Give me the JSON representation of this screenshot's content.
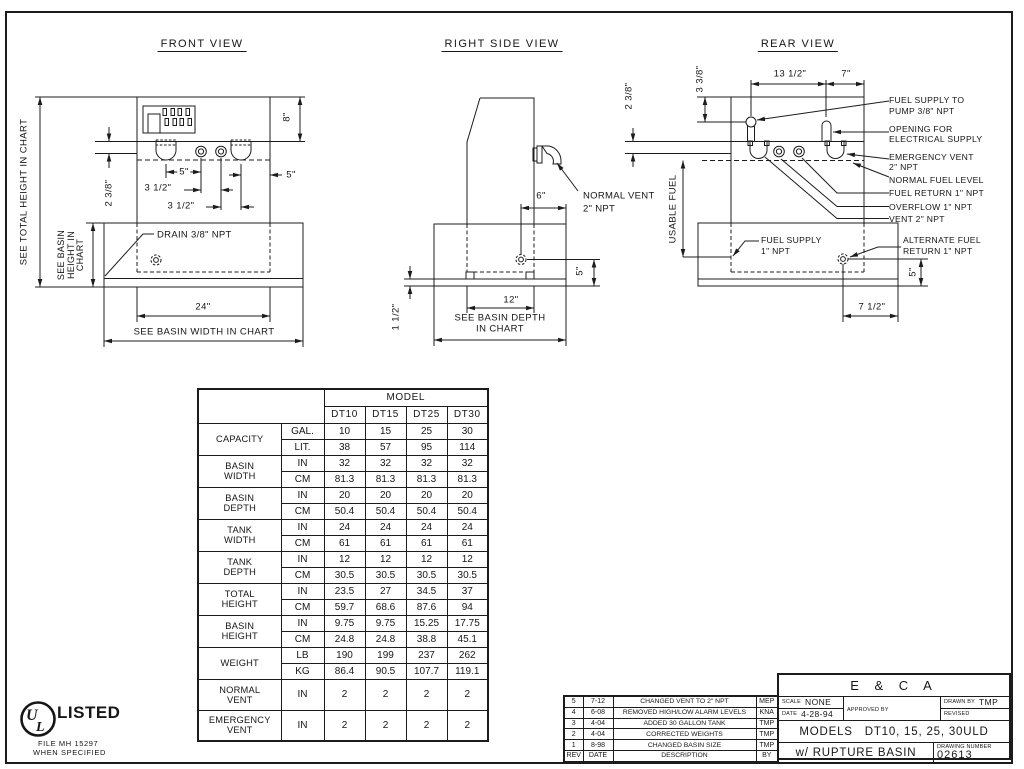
{
  "page": {
    "background": "#ffffff",
    "ink": "#1c1c1c"
  },
  "front": {
    "title": "FRONT VIEW",
    "see_total_height": "SEE TOTAL HEIGHT IN CHART",
    "see_basin_height": [
      "SEE BASIN",
      "HEIGHT IN",
      "CHART"
    ],
    "dim_2_3_8": "2 3/8\"",
    "dim_5_a": "5\"",
    "dim_3_1_2_a": "3 1/2\"",
    "dim_3_1_2_b": "3 1/2\"",
    "dim_5_b": "5\"",
    "dim_8": "8\"",
    "drain": "DRAIN 3/8\" NPT",
    "dim_24": "24\"",
    "see_basin_width": "SEE BASIN WIDTH IN CHART"
  },
  "side": {
    "title": "RIGHT SIDE VIEW",
    "normal_vent": [
      "NORMAL VENT",
      "2\" NPT"
    ],
    "dim_6": "6\"",
    "dim_12": "12\"",
    "see_basin_depth": [
      "SEE BASIN DEPTH",
      "IN CHART"
    ],
    "dim_1_1_2": "1 1/2\"",
    "dim_5": "5\""
  },
  "rear": {
    "title": "REAR VIEW",
    "dim_13_1_2": "13 1/2\"",
    "dim_7": "7\"",
    "dim_3_3_8": "3 3/8\"",
    "dim_2_3_8": "2 3/8\"",
    "usable_fuel": "USABLE FUEL",
    "callouts": {
      "pump": [
        "FUEL SUPPLY TO",
        "PUMP 3/8\" NPT"
      ],
      "electrical": [
        "OPENING FOR",
        "ELECTRICAL SUPPLY"
      ],
      "emergency": [
        "EMERGENCY VENT",
        "2\" NPT"
      ],
      "level": [
        "NORMAL FUEL LEVEL"
      ],
      "fuel_return": [
        "FUEL RETURN 1\" NPT"
      ],
      "overflow": [
        "OVERFLOW 1\" NPT"
      ],
      "vent": [
        "VENT 2\" NPT"
      ],
      "alt_return": [
        "ALTERNATE FUEL",
        "RETURN 1\" NPT"
      ],
      "fuel_supply": [
        "FUEL SUPPLY",
        "1\" NPT"
      ]
    },
    "dim_7_1_2": "7 1/2\"",
    "dim_5": "5\""
  },
  "chart_data": {
    "type": "table",
    "title": "MODEL",
    "columns": [
      "DT10",
      "DT15",
      "DT25",
      "DT30"
    ],
    "groups": [
      {
        "label_lines": [
          "CAPACITY"
        ],
        "rows": [
          {
            "unit": "GAL.",
            "values": [
              "10",
              "15",
              "25",
              "30"
            ]
          },
          {
            "unit": "LIT.",
            "values": [
              "38",
              "57",
              "95",
              "114"
            ]
          }
        ]
      },
      {
        "label_lines": [
          "BASIN",
          "WIDTH"
        ],
        "rows": [
          {
            "unit": "IN",
            "values": [
              "32",
              "32",
              "32",
              "32"
            ]
          },
          {
            "unit": "CM",
            "values": [
              "81.3",
              "81.3",
              "81.3",
              "81.3"
            ]
          }
        ]
      },
      {
        "label_lines": [
          "BASIN",
          "DEPTH"
        ],
        "rows": [
          {
            "unit": "IN",
            "values": [
              "20",
              "20",
              "20",
              "20"
            ]
          },
          {
            "unit": "CM",
            "values": [
              "50.4",
              "50.4",
              "50.4",
              "50.4"
            ]
          }
        ]
      },
      {
        "label_lines": [
          "TANK",
          "WIDTH"
        ],
        "rows": [
          {
            "unit": "IN",
            "values": [
              "24",
              "24",
              "24",
              "24"
            ]
          },
          {
            "unit": "CM",
            "values": [
              "61",
              "61",
              "61",
              "61"
            ]
          }
        ]
      },
      {
        "label_lines": [
          "TANK",
          "DEPTH"
        ],
        "rows": [
          {
            "unit": "IN",
            "values": [
              "12",
              "12",
              "12",
              "12"
            ]
          },
          {
            "unit": "CM",
            "values": [
              "30.5",
              "30.5",
              "30.5",
              "30.5"
            ]
          }
        ]
      },
      {
        "label_lines": [
          "TOTAL",
          "HEIGHT"
        ],
        "rows": [
          {
            "unit": "IN",
            "values": [
              "23.5",
              "27",
              "34.5",
              "37"
            ]
          },
          {
            "unit": "CM",
            "values": [
              "59.7",
              "68.6",
              "87.6",
              "94"
            ]
          }
        ]
      },
      {
        "label_lines": [
          "BASIN",
          "HEIGHT"
        ],
        "rows": [
          {
            "unit": "IN",
            "values": [
              "9.75",
              "9.75",
              "15.25",
              "17.75"
            ]
          },
          {
            "unit": "CM",
            "values": [
              "24.8",
              "24.8",
              "38.8",
              "45.1"
            ]
          }
        ]
      },
      {
        "label_lines": [
          "WEIGHT"
        ],
        "rows": [
          {
            "unit": "LB",
            "values": [
              "190",
              "199",
              "237",
              "262"
            ]
          },
          {
            "unit": "KG",
            "values": [
              "86.4",
              "90.5",
              "107.7",
              "119.1"
            ]
          }
        ]
      },
      {
        "label_lines": [
          "NORMAL",
          "VENT"
        ],
        "tall": true,
        "rows": [
          {
            "unit": "IN",
            "values": [
              "2",
              "2",
              "2",
              "2"
            ]
          }
        ]
      },
      {
        "label_lines": [
          "EMERGENCY",
          "VENT"
        ],
        "tall": true,
        "rows": [
          {
            "unit": "IN",
            "values": [
              "2",
              "2",
              "2",
              "2"
            ]
          }
        ]
      }
    ]
  },
  "revisions": {
    "header": {
      "rev": "REV",
      "date": "DATE",
      "description": "DESCRIPTION",
      "by": "BY"
    },
    "rows": [
      {
        "rev": "5",
        "date": "7-12",
        "description": "CHANGED VENT TO 2\" NPT",
        "by": "MEP"
      },
      {
        "rev": "4",
        "date": "6-08",
        "description": "REMOVED HIGH/LOW ALARM LEVELS",
        "by": "KNA"
      },
      {
        "rev": "3",
        "date": "4-04",
        "description": "ADDED 30 GALLON TANK",
        "by": "TMP"
      },
      {
        "rev": "2",
        "date": "4-04",
        "description": "CORRECTED WEIGHTS",
        "by": "TMP"
      },
      {
        "rev": "1",
        "date": "8-98",
        "description": "CHANGED BASIN SIZE",
        "by": "TMP"
      }
    ]
  },
  "title_block": {
    "company": "E & C A",
    "scale_label": "SCALE",
    "scale_value": "NONE",
    "date_label": "DATE",
    "date_value": "4-28-94",
    "approved_label": "APPROVED BY",
    "drawn_label": "DRAWN BY",
    "drawn_value": "TMP",
    "revised_label": "REVISED",
    "models_label": "MODELS",
    "models_value": "DT10, 15, 25, 30ULD",
    "subtitle": "w/ RUPTURE BASIN",
    "drawing_number_label": "DRAWING NUMBER",
    "drawing_number": "02613"
  },
  "ul": {
    "monogram_u": "U",
    "monogram_l": "L",
    "listed": "LISTED",
    "file_line": "FILE MH 15297",
    "when_line": "WHEN SPECIFIED"
  }
}
